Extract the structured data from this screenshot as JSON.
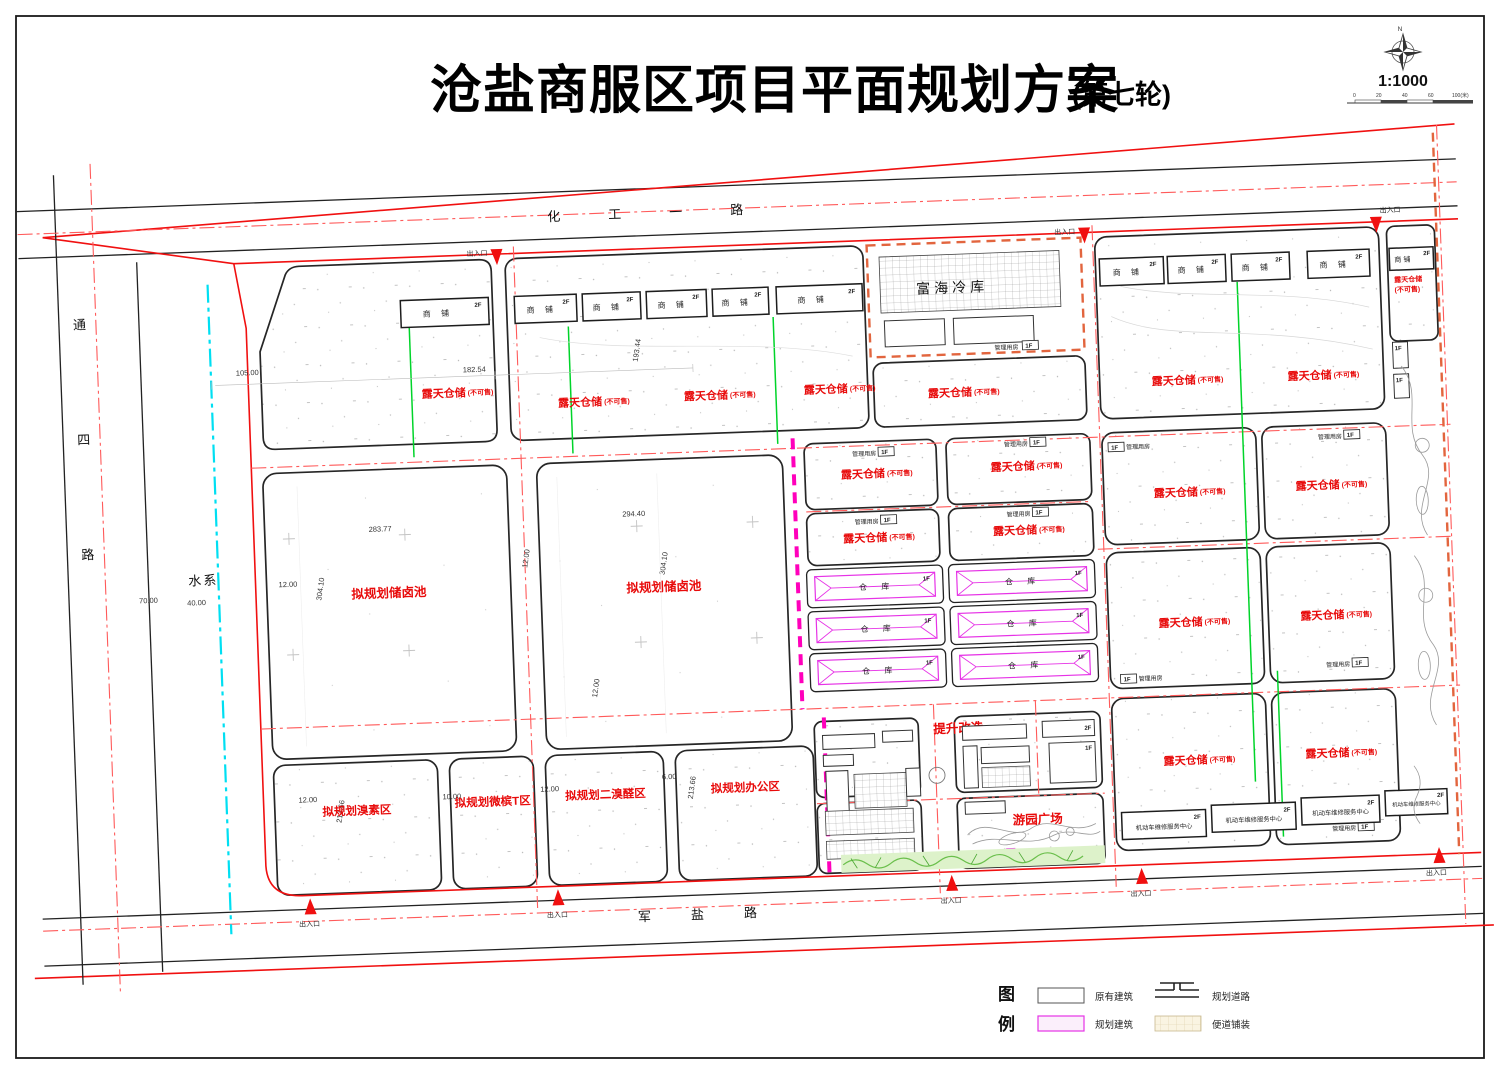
{
  "title": {
    "main": "沧盐商服区项目平面规划方案",
    "round": "(第七轮)",
    "scale_text": "1:1000",
    "north": "N",
    "scalebar_ticks": [
      "0",
      "20",
      "40",
      "60",
      "100(米)"
    ]
  },
  "roads": {
    "top": "化工一路",
    "bottom": "军盐路",
    "left_chars": [
      "通",
      "四",
      "路"
    ],
    "water": "水系"
  },
  "labels": {
    "open_storage": "露天仓储",
    "not_for_sale": "(不可售)",
    "shop": "商 铺",
    "warehouse": "仓  库",
    "mgmt_room": "管理用房",
    "entrance": "出入口",
    "repair_center": "机动车维修服务中心",
    "floor1": "1F",
    "floor2": "2F"
  },
  "parcels": {
    "brine_pool": "拟规划储卤池",
    "bromine_zone": "拟规划溴素区",
    "weibin_zone": "拟规划微槟T区",
    "dibromide_zone": "拟规划二溴醛区",
    "office_zone": "拟规划办公区",
    "cold_storage": "富海冷库"
  },
  "areas": {
    "upgrade": "提升改造",
    "parking": "停车场",
    "plaza": "游园广场"
  },
  "legend": {
    "title_chars": [
      "图",
      "例"
    ],
    "items": [
      {
        "label": "原有建筑"
      },
      {
        "label": "规划建筑"
      },
      {
        "label": "规划道路"
      },
      {
        "label": "便道铺装"
      }
    ]
  },
  "dims": {
    "d105": "105.00",
    "d182": "182.54",
    "d193": "193.44",
    "d283": "283.77",
    "d294": "294.40",
    "d304": "304.10",
    "d70": "70.00",
    "d40": "40.00",
    "d12": "12.00",
    "d10": "10.00",
    "d6": "6.00",
    "d213": "213.66"
  },
  "colors": {
    "red_label": "#e80b0b",
    "boundary_red": "#f01010",
    "centerline": "#ff5a5a",
    "magenta": "#e633e6",
    "pink_dash": "#ff00bb",
    "green": "#00d42a",
    "cyan": "#00dff2",
    "orange_dash": "#e2653e"
  }
}
